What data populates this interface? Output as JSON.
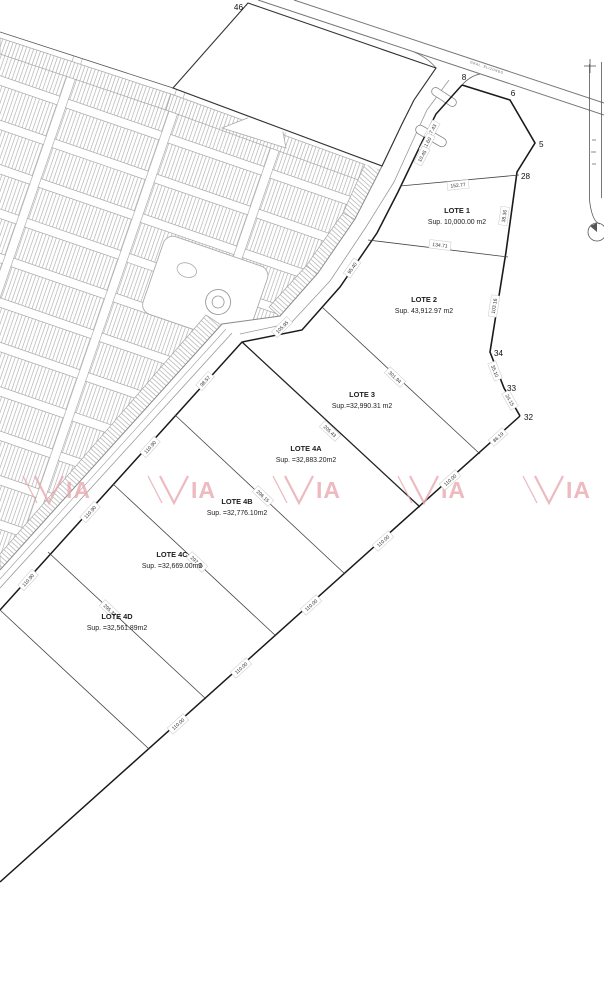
{
  "map": {
    "road_label": "GRAL. ELIZONDO",
    "colors": {
      "boundary": "#1a1a1a",
      "division": "#444444",
      "road_gray": "#8a8a8a",
      "subdivision_gray": "#b0b0b0",
      "watermark": "#e8a9b0"
    },
    "lots": [
      {
        "name": "LOTE 1",
        "area": "Sup. 10,000.00 m2",
        "x": 457,
        "y": 213
      },
      {
        "name": "LOTE 2",
        "area": "Sup. 43,912.97 m2",
        "x": 424,
        "y": 302
      },
      {
        "name": "LOTE 3",
        "area": "Sup.=32,990.31 m2",
        "x": 362,
        "y": 397
      },
      {
        "name": "LOTE 4A",
        "area": "Sup. =32,883.20m2",
        "x": 306,
        "y": 451
      },
      {
        "name": "LOTE 4B",
        "area": "Sup. =32,776.10m2",
        "x": 237,
        "y": 504
      },
      {
        "name": "LOTE 4C",
        "area": "Sup. =32,669.00m2",
        "x": 172,
        "y": 557
      },
      {
        "name": "LOTE 4D",
        "area": "Sup. =32,561.89m2",
        "x": 117,
        "y": 619
      }
    ],
    "vertices": [
      {
        "n": "46",
        "x": 243,
        "y": 10,
        "anchor": "end"
      },
      {
        "n": "8",
        "x": 464,
        "y": 80,
        "anchor": "middle"
      },
      {
        "n": "6",
        "x": 513,
        "y": 96,
        "anchor": "middle"
      },
      {
        "n": "5",
        "x": 539,
        "y": 147,
        "anchor": "start"
      },
      {
        "n": "28",
        "x": 521,
        "y": 179,
        "anchor": "start"
      },
      {
        "n": "34",
        "x": 494,
        "y": 356,
        "anchor": "start"
      },
      {
        "n": "33",
        "x": 507,
        "y": 391,
        "anchor": "start"
      },
      {
        "n": "32",
        "x": 524,
        "y": 420,
        "anchor": "start"
      }
    ],
    "dimensions": [
      {
        "v": "152.77",
        "x": 458,
        "y": 185,
        "r": -6
      },
      {
        "v": "134.71",
        "x": 440,
        "y": 245,
        "r": 7
      },
      {
        "v": "38.36",
        "x": 504,
        "y": 216,
        "r": -82
      },
      {
        "v": "103.16",
        "x": 494,
        "y": 306,
        "r": -81
      },
      {
        "v": "35.10",
        "x": 495,
        "y": 371,
        "r": 69
      },
      {
        "v": "24.15",
        "x": 510,
        "y": 400,
        "r": 60
      },
      {
        "v": "86.19",
        "x": 498,
        "y": 437,
        "r": -42
      },
      {
        "v": "301.94",
        "x": 395,
        "y": 377,
        "r": 43
      },
      {
        "v": "205.43",
        "x": 330,
        "y": 431,
        "r": 43
      },
      {
        "v": "296.15",
        "x": 263,
        "y": 496,
        "r": 43
      },
      {
        "v": "297.48",
        "x": 197,
        "y": 562,
        "r": 43
      },
      {
        "v": "295.33",
        "x": 110,
        "y": 610,
        "r": 43
      },
      {
        "v": "110.00",
        "x": 450,
        "y": 480,
        "r": -42
      },
      {
        "v": "110.00",
        "x": 383,
        "y": 541,
        "r": -42
      },
      {
        "v": "110.00",
        "x": 311,
        "y": 605,
        "r": -42
      },
      {
        "v": "110.00",
        "x": 241,
        "y": 668,
        "r": -42
      },
      {
        "v": "110.00",
        "x": 178,
        "y": 724,
        "r": -42
      },
      {
        "v": "95.40",
        "x": 352,
        "y": 268,
        "r": -55
      },
      {
        "v": "105.95",
        "x": 282,
        "y": 327,
        "r": -45
      },
      {
        "v": "98.57",
        "x": 205,
        "y": 381,
        "r": -48
      },
      {
        "v": "110.90",
        "x": 150,
        "y": 447,
        "r": -48
      },
      {
        "v": "110.90",
        "x": 90,
        "y": 512,
        "r": -48
      },
      {
        "v": "110.90",
        "x": 28,
        "y": 580,
        "r": -48
      },
      {
        "v": "17.43",
        "x": 432,
        "y": 130,
        "r": -62
      },
      {
        "v": "11.60",
        "x": 427,
        "y": 143,
        "r": -62
      },
      {
        "v": "10.45",
        "x": 422,
        "y": 156,
        "r": -62
      }
    ],
    "watermark": {
      "text": "VIA",
      "positions": [
        {
          "x": 57,
          "y": 490
        },
        {
          "x": 182,
          "y": 490
        },
        {
          "x": 307,
          "y": 490
        },
        {
          "x": 432,
          "y": 490
        },
        {
          "x": 557,
          "y": 490
        }
      ]
    }
  }
}
